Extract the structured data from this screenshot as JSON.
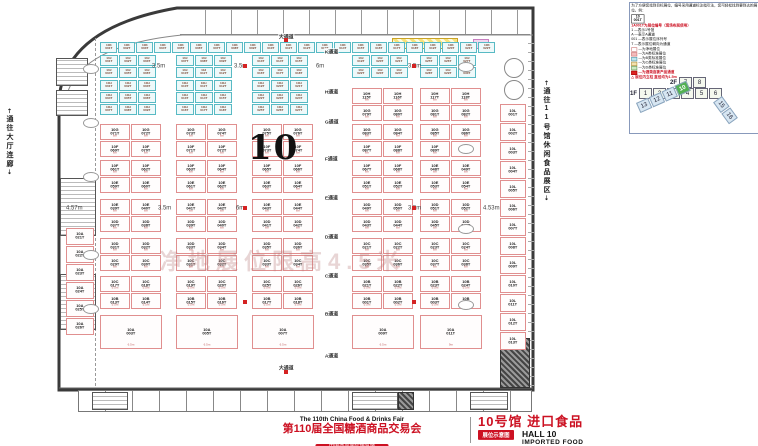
{
  "colors": {
    "accent_red": "#cc1122",
    "booth_std_border": "#58bac4",
    "booth_net_border": "#e08f8f",
    "active_green": "#53b152"
  },
  "legend": {
    "intro": "为了方便您找到目标展位，编号采用通道标注指引法，您可轻松找到要到达的展位。例：",
    "sample_top": "10",
    "sample_bottom": "001T",
    "code_line": "1A001T为展位编号（现场布展使用）",
    "code_items": [
      "1 —表示1号馆",
      "A —表示A通道",
      "001 —表示展位序列号",
      "T —表示展位朝向为通道"
    ],
    "swatches": [
      {
        "label": "—为净地展位",
        "color": "#ffffff",
        "border": "#cc7777",
        "red": false
      },
      {
        "label": "—为A类标准展位",
        "color": "#f3bcbc",
        "border": "#cc7777",
        "red": false
      },
      {
        "label": "—为B类标准展位",
        "color": "#bfe6ee",
        "border": "#5599aa",
        "red": false
      },
      {
        "label": "—为C类标准展位",
        "color": "#f2e3ae",
        "border": "#b09040",
        "red": false
      },
      {
        "label": "—为D类标准展位",
        "color": "#cdeac2",
        "border": "#6a9a5a",
        "red": false
      },
      {
        "label": "—为酒类连锁产品通道",
        "color": "#dd2222",
        "border": "#aa0000",
        "red": true
      }
    ],
    "pillar_note": "展位内立柱 直径均为1.5m"
  },
  "minimap": {
    "floors": [
      {
        "label": "2F",
        "cells": [
          "7",
          "8"
        ]
      },
      {
        "label": "1F",
        "cells": [
          "1",
          "2",
          "3",
          "4",
          "5",
          "6"
        ]
      }
    ],
    "strip_main": {
      "cells": [
        "13",
        "12",
        "11",
        "10"
      ],
      "active": "10"
    },
    "strip_side": {
      "cells": [
        "15",
        "16"
      ]
    }
  },
  "footer": {
    "fair_en": "The 110th China Food & Drinks Fair",
    "fair_cn": "第110届全国糖酒商品交易会",
    "venue": "中国西部国际博览城",
    "hall_cn": "10号馆 进口食品",
    "hall_en": "HALL 10",
    "hall_en2": "IMPORTED FOOD",
    "badge": "展位示意图"
  },
  "plan": {
    "hall_number": "10",
    "watermark": "净地展位限高4.5米",
    "left_corridor": "通往大厅连廊",
    "right_corridor": "通往11号馆休闲食品展区",
    "aisle_labels": [
      {
        "t": "大通道",
        "x": 278,
        "y": 33
      },
      {
        "t": "K通道",
        "x": 324,
        "y": 48
      },
      {
        "t": "H通道",
        "x": 324,
        "y": 88
      },
      {
        "t": "G通道",
        "x": 324,
        "y": 118
      },
      {
        "t": "F通道",
        "x": 324,
        "y": 155
      },
      {
        "t": "E通道",
        "x": 324,
        "y": 194
      },
      {
        "t": "D通道",
        "x": 324,
        "y": 233
      },
      {
        "t": "C通道",
        "x": 324,
        "y": 272
      },
      {
        "t": "B通道",
        "x": 324,
        "y": 310
      },
      {
        "t": "A通道",
        "x": 324,
        "y": 352
      },
      {
        "t": "大通道",
        "x": 278,
        "y": 364
      }
    ],
    "width_labels": [
      {
        "t": "3.5m",
        "x": 152,
        "y": 63
      },
      {
        "t": "3.5m",
        "x": 234,
        "y": 63
      },
      {
        "t": "6m",
        "x": 316,
        "y": 63
      },
      {
        "t": "3.5m",
        "x": 408,
        "y": 63
      },
      {
        "t": "4.57m",
        "x": 66,
        "y": 205
      },
      {
        "t": "3.5m",
        "x": 158,
        "y": 205
      },
      {
        "t": "6m",
        "x": 236,
        "y": 205
      },
      {
        "t": "3.5m",
        "x": 408,
        "y": 205
      },
      {
        "t": "4.53m",
        "x": 483,
        "y": 205
      }
    ],
    "markers": [
      [
        284,
        38
      ],
      [
        243,
        64
      ],
      [
        412,
        64
      ],
      [
        243,
        206
      ],
      [
        412,
        206
      ],
      [
        243,
        300
      ],
      [
        412,
        300
      ],
      [
        284,
        370
      ]
    ],
    "islands": [
      {
        "x": 100,
        "y": 42,
        "c": 22,
        "r": 1,
        "w": 17,
        "h": 11,
        "t": "std",
        "pre": "10K",
        "s": 1
      },
      {
        "x": 100,
        "y": 55,
        "c": 3,
        "r": 2,
        "w": 18,
        "h": 11,
        "t": "std",
        "pre": "10J",
        "s": 1
      },
      {
        "x": 176,
        "y": 55,
        "c": 3,
        "r": 2,
        "w": 18,
        "h": 11,
        "t": "std",
        "pre": "10J",
        "s": 7
      },
      {
        "x": 252,
        "y": 55,
        "c": 3,
        "r": 2,
        "w": 18,
        "h": 11,
        "t": "std",
        "pre": "10J",
        "s": 13
      },
      {
        "x": 352,
        "y": 55,
        "c": 3,
        "r": 2,
        "w": 18,
        "h": 11,
        "t": "std",
        "pre": "10J",
        "s": 19
      },
      {
        "x": 420,
        "y": 55,
        "c": 3,
        "r": 2,
        "w": 18,
        "h": 11,
        "t": "std",
        "pre": "10J",
        "s": 25
      },
      {
        "x": 100,
        "y": 80,
        "c": 3,
        "r": 3,
        "w": 18,
        "h": 11,
        "t": "std",
        "pre": "10H",
        "s": 1
      },
      {
        "x": 176,
        "y": 80,
        "c": 3,
        "r": 3,
        "w": 18,
        "h": 11,
        "t": "std",
        "pre": "10H",
        "s": 10
      },
      {
        "x": 252,
        "y": 80,
        "c": 3,
        "r": 3,
        "w": 18,
        "h": 11,
        "t": "std",
        "pre": "10H",
        "s": 19
      },
      {
        "x": 352,
        "y": 88,
        "c": 2,
        "r": 2,
        "w": 30,
        "h": 16,
        "t": "net",
        "sz": "6m",
        "ids": [
          "10H 115T",
          "10H 116T",
          "10G 079T",
          "10G 080T"
        ]
      },
      {
        "x": 420,
        "y": 88,
        "c": 2,
        "r": 2,
        "w": 30,
        "h": 16,
        "t": "net",
        "sz": "6m",
        "ids": [
          "10H 117T",
          "10H 118T",
          "10G 081T",
          "10G 082T"
        ]
      },
      {
        "x": 100,
        "y": 124,
        "c": 2,
        "r": 2,
        "w": 30,
        "h": 16,
        "t": "net",
        "sz": "6m",
        "ids": [
          "10G 071T",
          "10G 072T",
          "10F 069T",
          "10F 070T"
        ]
      },
      {
        "x": 176,
        "y": 124,
        "c": 2,
        "r": 2,
        "w": 30,
        "h": 16,
        "t": "net",
        "sz": "6m",
        "ids": [
          "10G 073T",
          "10G 074T",
          "10F 071T",
          "10F 072T"
        ]
      },
      {
        "x": 252,
        "y": 124,
        "c": 2,
        "r": 2,
        "w": 30,
        "h": 16,
        "t": "net",
        "sz": "6m",
        "ids": [
          "10G 075T",
          "10G 076T",
          "10F 073T",
          "10F 074T"
        ]
      },
      {
        "x": 352,
        "y": 124,
        "c": 2,
        "r": 2,
        "w": 30,
        "h": 16,
        "t": "net",
        "sz": "6m",
        "ids": [
          "10G 083T",
          "10G 084T",
          "10F 087T",
          "10F 088T"
        ]
      },
      {
        "x": 420,
        "y": 124,
        "c": 2,
        "r": 2,
        "w": 30,
        "h": 16,
        "t": "net",
        "sz": "6m",
        "ids": [
          "10G 085T",
          "10G 086T",
          "10F 089T",
          "10F 090T"
        ]
      },
      {
        "x": 100,
        "y": 160,
        "c": 2,
        "r": 2,
        "w": 30,
        "h": 16,
        "t": "net",
        "sz": "6m",
        "ids": [
          "10F 061T",
          "10F 062T",
          "10E 059T",
          "10E 060T"
        ]
      },
      {
        "x": 176,
        "y": 160,
        "c": 2,
        "r": 2,
        "w": 30,
        "h": 16,
        "t": "net",
        "sz": "6m",
        "ids": [
          "10F 063T",
          "10F 064T",
          "10E 061T",
          "10E 062T"
        ]
      },
      {
        "x": 252,
        "y": 160,
        "c": 2,
        "r": 2,
        "w": 30,
        "h": 16,
        "t": "net",
        "sz": "6m",
        "ids": [
          "10F 065T",
          "10F 066T",
          "10E 063T",
          "10E 064T"
        ]
      },
      {
        "x": 352,
        "y": 160,
        "c": 2,
        "r": 2,
        "w": 30,
        "h": 16,
        "t": "net",
        "sz": "6m",
        "ids": [
          "10F 067T",
          "10F 068T",
          "10E 051T",
          "10E 052T"
        ]
      },
      {
        "x": 420,
        "y": 160,
        "c": 2,
        "r": 2,
        "w": 30,
        "h": 16,
        "t": "net",
        "sz": "6m",
        "ids": [
          "10E 048T",
          "10E 049T",
          "10E 053T",
          "10E 054T"
        ]
      },
      {
        "x": 100,
        "y": 199,
        "c": 2,
        "r": 2,
        "w": 30,
        "h": 16,
        "t": "net",
        "sz": "6m",
        "ids": [
          "10E 039T",
          "10E 040T",
          "10D 037T",
          "10D 038T"
        ]
      },
      {
        "x": 176,
        "y": 199,
        "c": 2,
        "r": 2,
        "w": 30,
        "h": 16,
        "t": "net",
        "sz": "6m",
        "ids": [
          "10E 041T",
          "10E 042T",
          "10D 039T",
          "10D 040T"
        ]
      },
      {
        "x": 252,
        "y": 199,
        "c": 2,
        "r": 2,
        "w": 30,
        "h": 16,
        "t": "net",
        "sz": "6m",
        "ids": [
          "10E 043T",
          "10E 044T",
          "10D 041T",
          "10D 042T"
        ]
      },
      {
        "x": 352,
        "y": 199,
        "c": 2,
        "r": 2,
        "w": 30,
        "h": 16,
        "t": "net",
        "sz": "6m",
        "ids": [
          "10D 049T",
          "10D 050T",
          "10D 043T",
          "10D 044T"
        ]
      },
      {
        "x": 420,
        "y": 199,
        "c": 2,
        "r": 2,
        "w": 30,
        "h": 16,
        "t": "net",
        "sz": "6m",
        "ids": [
          "10D 051T",
          "10D 052T",
          "10D 045T",
          "10D 046T"
        ]
      },
      {
        "x": 100,
        "y": 238,
        "c": 2,
        "r": 2,
        "w": 30,
        "h": 16,
        "t": "net",
        "sz": "6m",
        "ids": [
          "10D 031T",
          "10D 032T",
          "10C 029T",
          "10C 030T"
        ]
      },
      {
        "x": 176,
        "y": 238,
        "c": 2,
        "r": 2,
        "w": 30,
        "h": 16,
        "t": "net",
        "sz": "6m",
        "ids": [
          "10D 033T",
          "10D 034T",
          "10C 031T",
          "10C 032T"
        ]
      },
      {
        "x": 252,
        "y": 238,
        "c": 2,
        "r": 2,
        "w": 30,
        "h": 16,
        "t": "net",
        "sz": "6m",
        "ids": [
          "10D 035T",
          "10D 036T",
          "10C 033T",
          "10C 034T"
        ]
      },
      {
        "x": 352,
        "y": 238,
        "c": 2,
        "r": 2,
        "w": 30,
        "h": 16,
        "t": "net",
        "sz": "6m",
        "ids": [
          "10C 021T",
          "10C 022T",
          "10C 035T",
          "10C 036T"
        ]
      },
      {
        "x": 420,
        "y": 238,
        "c": 2,
        "r": 2,
        "w": 30,
        "h": 16,
        "t": "net",
        "sz": "6m",
        "ids": [
          "10C 023T",
          "10C 024T",
          "10C 037T",
          "10C 038T"
        ]
      },
      {
        "x": 100,
        "y": 276,
        "c": 2,
        "r": 2,
        "w": 30,
        "h": 16,
        "t": "net",
        "sz": "5.5m",
        "ids": [
          "10C 017T",
          "10C 018T",
          "10B 013T",
          "10B 014T"
        ]
      },
      {
        "x": 176,
        "y": 276,
        "c": 2,
        "r": 2,
        "w": 30,
        "h": 16,
        "t": "net",
        "sz": "5.5m",
        "ids": [
          "10C 019T",
          "10C 020T",
          "10B 015T",
          "10B 016T"
        ]
      },
      {
        "x": 252,
        "y": 276,
        "c": 2,
        "r": 2,
        "w": 30,
        "h": 16,
        "t": "net",
        "sz": "5.5m",
        "ids": [
          "10C 025T",
          "10C 026T",
          "10B 017T",
          "10B 018T"
        ]
      },
      {
        "x": 352,
        "y": 276,
        "c": 2,
        "r": 2,
        "w": 30,
        "h": 16,
        "t": "net",
        "sz": "5.5m",
        "ids": [
          "10B 021T",
          "10B 022T",
          "10B 001T",
          "10B 002T"
        ]
      },
      {
        "x": 420,
        "y": 276,
        "c": 2,
        "r": 2,
        "w": 30,
        "h": 16,
        "t": "net",
        "sz": "5.5m",
        "ids": [
          "10B 023T",
          "10B 024T",
          "10B 003T",
          "10B 004T"
        ]
      },
      {
        "x": 100,
        "y": 315,
        "c": 1,
        "r": 1,
        "w": 62,
        "h": 34,
        "t": "net",
        "sz": "6.5m",
        "ids": [
          "10A 003T"
        ]
      },
      {
        "x": 176,
        "y": 315,
        "c": 1,
        "r": 1,
        "w": 62,
        "h": 34,
        "t": "net",
        "sz": "6.5m",
        "ids": [
          "10A 005T"
        ]
      },
      {
        "x": 252,
        "y": 315,
        "c": 1,
        "r": 1,
        "w": 62,
        "h": 34,
        "t": "net",
        "sz": "6.5m",
        "ids": [
          "10A 007T"
        ]
      },
      {
        "x": 352,
        "y": 315,
        "c": 1,
        "r": 1,
        "w": 62,
        "h": 34,
        "t": "net",
        "sz": "6.5m",
        "ids": [
          "10A 009T"
        ]
      },
      {
        "x": 420,
        "y": 315,
        "c": 1,
        "r": 1,
        "w": 62,
        "h": 34,
        "t": "net",
        "sz": "9m",
        "ids": [
          "10A 011T"
        ]
      },
      {
        "x": 66,
        "y": 228,
        "c": 1,
        "r": 6,
        "w": 28,
        "h": 17,
        "t": "net",
        "pre": "10A",
        "s": 21
      },
      {
        "x": 500,
        "y": 104,
        "c": 1,
        "r": 13,
        "w": 26,
        "h": 18,
        "t": "net",
        "pre": "10L",
        "s": 1
      }
    ]
  }
}
